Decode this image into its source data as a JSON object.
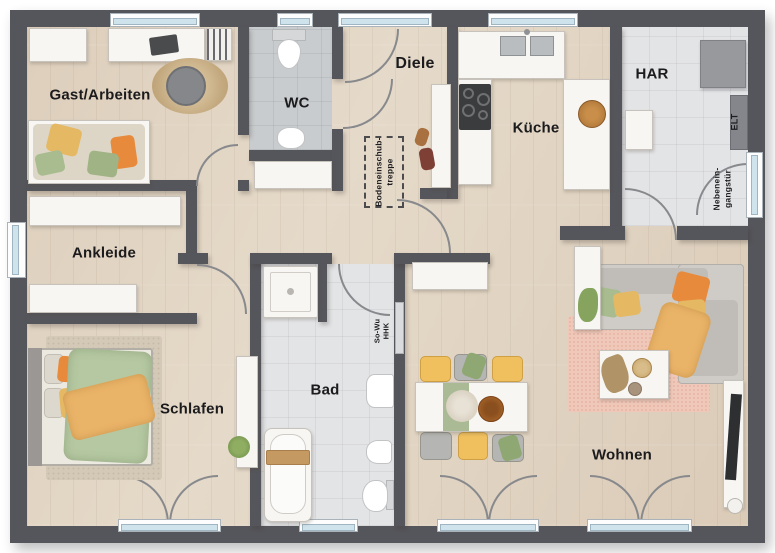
{
  "plan": {
    "rooms": [
      {
        "id": "gast",
        "label": "Gast/Arbeiten"
      },
      {
        "id": "wc",
        "label": "WC"
      },
      {
        "id": "diele",
        "label": "Diele"
      },
      {
        "id": "kueche",
        "label": "Küche"
      },
      {
        "id": "har",
        "label": "HAR"
      },
      {
        "id": "ankleide",
        "label": "Ankleide"
      },
      {
        "id": "schlafen",
        "label": "Schlafen"
      },
      {
        "id": "bad",
        "label": "Bad"
      },
      {
        "id": "wohnen",
        "label": "Wohnen"
      }
    ],
    "annotations": {
      "attic_stairs": {
        "line1": "Bodeneinschub-",
        "line2": "treppe"
      },
      "side_entrance": {
        "line1": "Nebenein-",
        "line2": "gangstür"
      },
      "elt": "ELT",
      "radiator": {
        "line1": "So-Wu",
        "line2": "HHK"
      }
    },
    "colors": {
      "wall": "#55565b",
      "wood_floor": "#e2d5c3",
      "tile_floor": "#e3e4e6",
      "tile_floor_dark": "#c9ccce",
      "window_glass": "#cfe3ed",
      "accent_orange": "#e88a3c",
      "accent_yellow": "#e5b863",
      "accent_green": "#a8bc8f",
      "rug_pink": "#f0c8ba"
    }
  }
}
